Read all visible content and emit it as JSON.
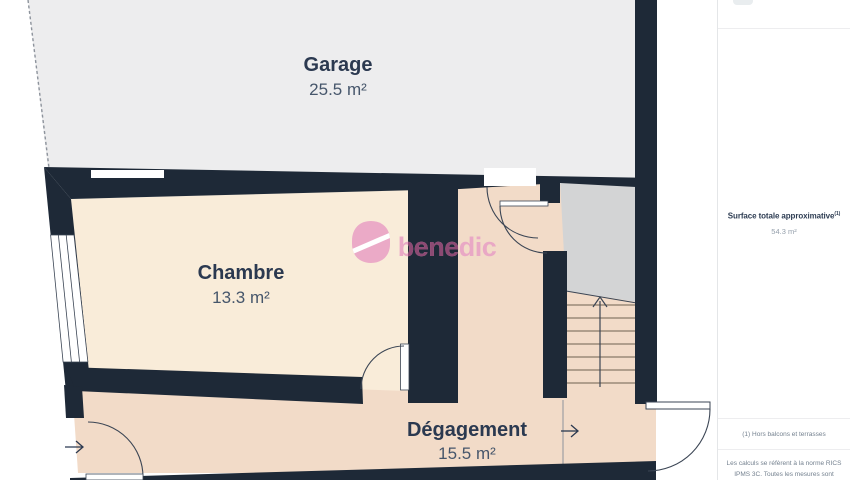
{
  "watermark": {
    "brand": "benedic"
  },
  "rooms": [
    {
      "id": "garage",
      "name": "Garage",
      "area": "25.5 m²"
    },
    {
      "id": "chambre",
      "name": "Chambre",
      "area": "13.3 m²"
    },
    {
      "id": "degagement",
      "name": "Dégagement",
      "area": "15.5 m²"
    }
  ],
  "sidebar": {
    "total_label": "Surface totale approximative",
    "total_footnote_ref": "(1)",
    "total_value": "54.3 m²",
    "footnote_1": "(1) Hors balcons et terrasses",
    "footnote_2_line_1": "Les calculs se réfèrent à la norme RICS",
    "footnote_2_line_2": "IPMS 3C. Toutes les mesures sont"
  },
  "colors": {
    "wall": "#1e2937",
    "garage_floor": "#ededee",
    "chambre_floor": "#f9ecd9",
    "degagement_floor": "#f2dbc8",
    "stair_landing": "#d3d4d5",
    "brand_pink": "#e9a4c5",
    "brand_pink_on_wall": "#8c4a73",
    "label_dark": "#2b3950",
    "label_muted": "#46566b"
  }
}
